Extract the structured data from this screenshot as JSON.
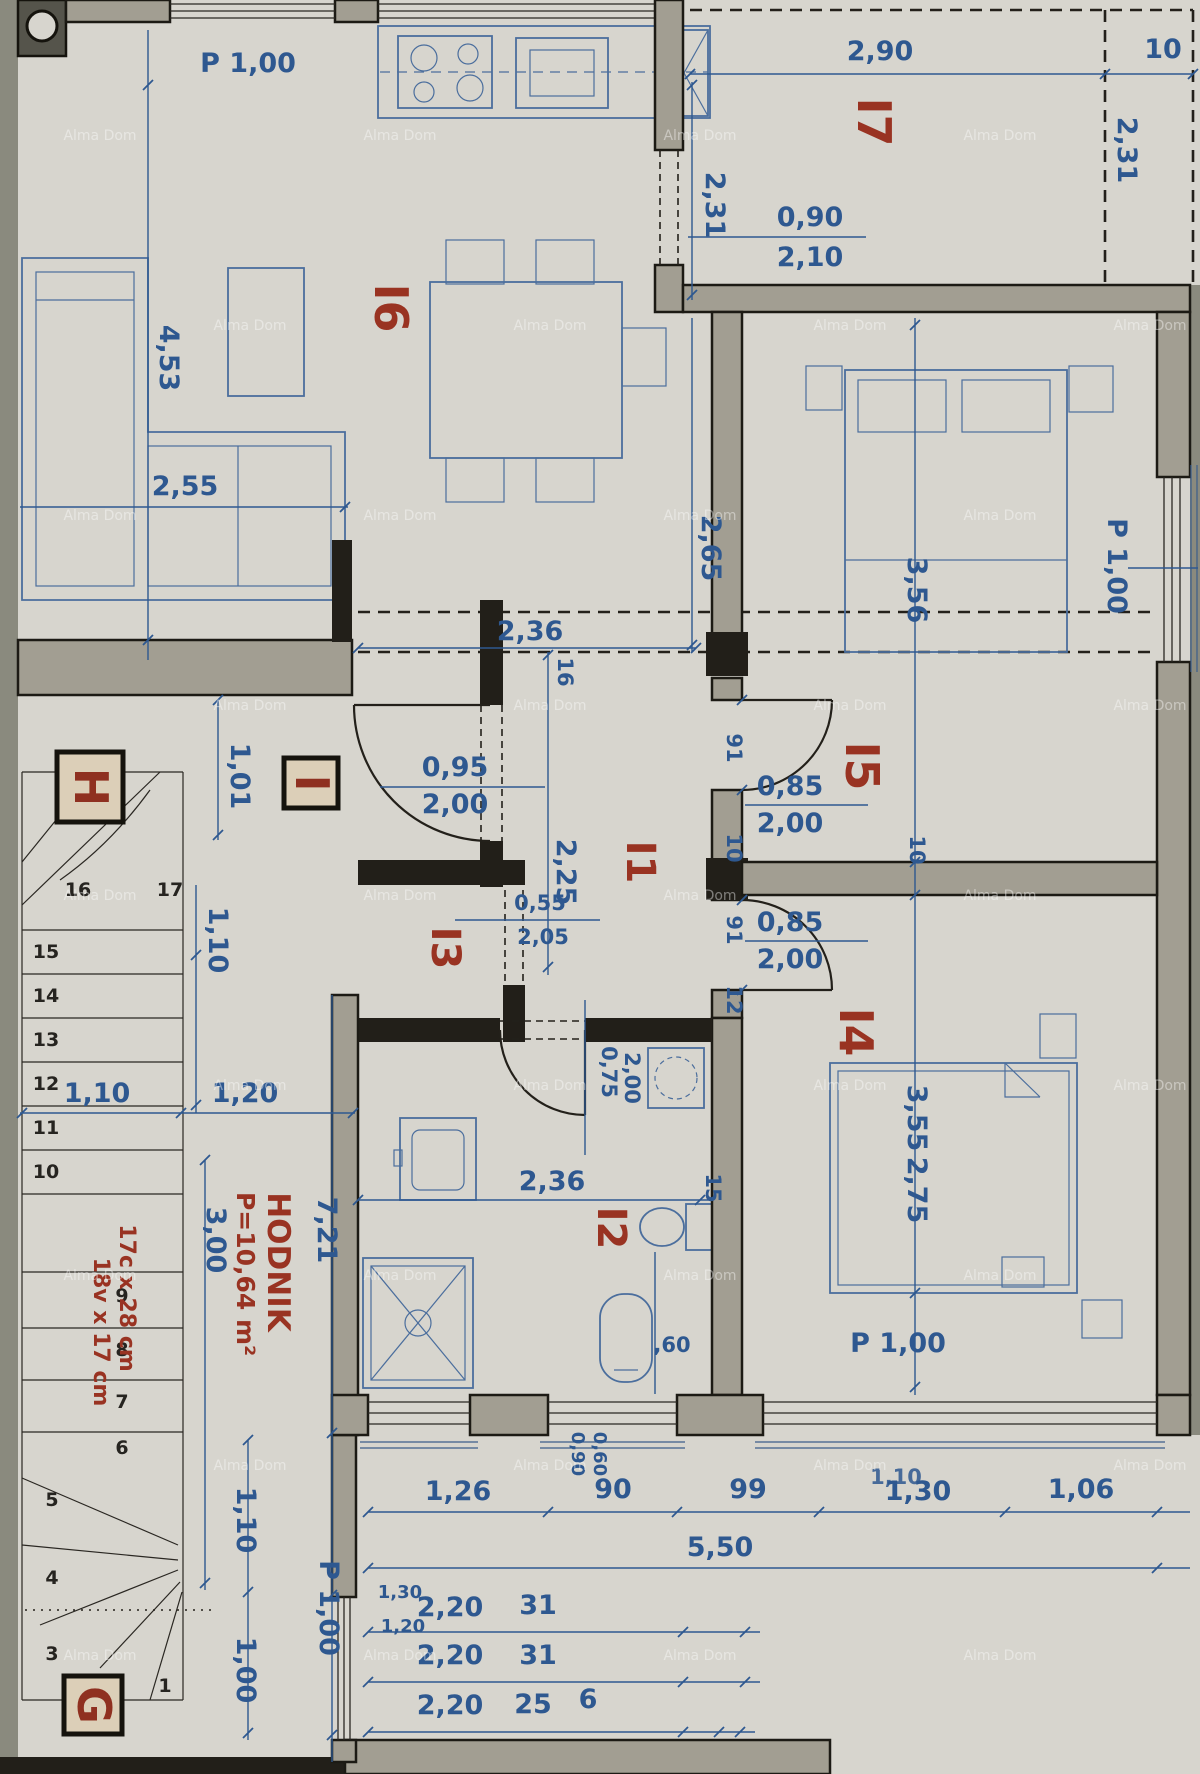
{
  "watermark": "Alma Dom",
  "rooms": {
    "i1": "I1",
    "i2": "I2",
    "i3": "I3",
    "i4": "I4",
    "i5": "I5",
    "i6": "I6",
    "i7": "I7",
    "h": "H",
    "i": "I",
    "g": "G"
  },
  "hodnik": {
    "name": "HODNIK",
    "area": "P=10,64 m²",
    "len": "3,00",
    "total": "7,21"
  },
  "stair_note": {
    "line1": "17c x 28 cm",
    "line2": "18v x 17 cm"
  },
  "steps": [
    "1",
    "2",
    "3",
    "4",
    "5",
    "6",
    "7",
    "8",
    "9",
    "10",
    "11",
    "12",
    "13",
    "14",
    "15",
    "16",
    "17"
  ],
  "dims": {
    "p100_kitchen": "P 1,00",
    "w290": "2,90",
    "w10": "10",
    "h231_r": "2,31",
    "h231_l": "2,31",
    "door_terrace": {
      "w": "0,90",
      "h": "2,10"
    },
    "h453": "4,53",
    "w255": "2,55",
    "h265": "2,65",
    "w236_top": "2,36",
    "t16": "16",
    "h356": "3,56",
    "p100_i5": "P 1,00",
    "h225": "2,25",
    "w101": "1,01",
    "door_entry": {
      "w": "0,95",
      "h": "2,00"
    },
    "door_i5": {
      "w": "0,85",
      "h": "2,00"
    },
    "door_i4": {
      "w": "0,85",
      "h": "2,00"
    },
    "door_i3": {
      "w": "0,55",
      "h": "2,05"
    },
    "door_i2": {
      "w": "0,75",
      "h": "2,00"
    },
    "chain": [
      "91",
      "10",
      "91",
      "12"
    ],
    "w110_stairs": "1,10",
    "w120_hall": "1,20",
    "h110_stairs": "1,10",
    "h355": "3,55",
    "h275": "2,75",
    "t10": "10",
    "t15": "15",
    "w236_bath": "2,36",
    "wc60": ",60",
    "p100_i4": "P 1,00",
    "row1": [
      "1,26",
      "90",
      "99",
      "1,30",
      "1,06"
    ],
    "row1_overlap": "1,10",
    "total550": "5,50",
    "s130": "1,30",
    "s120": "1,20",
    "row3": [
      "2,20",
      "31"
    ],
    "row4": [
      "2,20",
      "31"
    ],
    "row5": [
      "2,20",
      "25",
      "6"
    ],
    "pier090": "0,90",
    "pier060": "0,60",
    "h110_bl": "1,10",
    "h100_bl": "1,00",
    "p100_bl": "P 1,00"
  }
}
